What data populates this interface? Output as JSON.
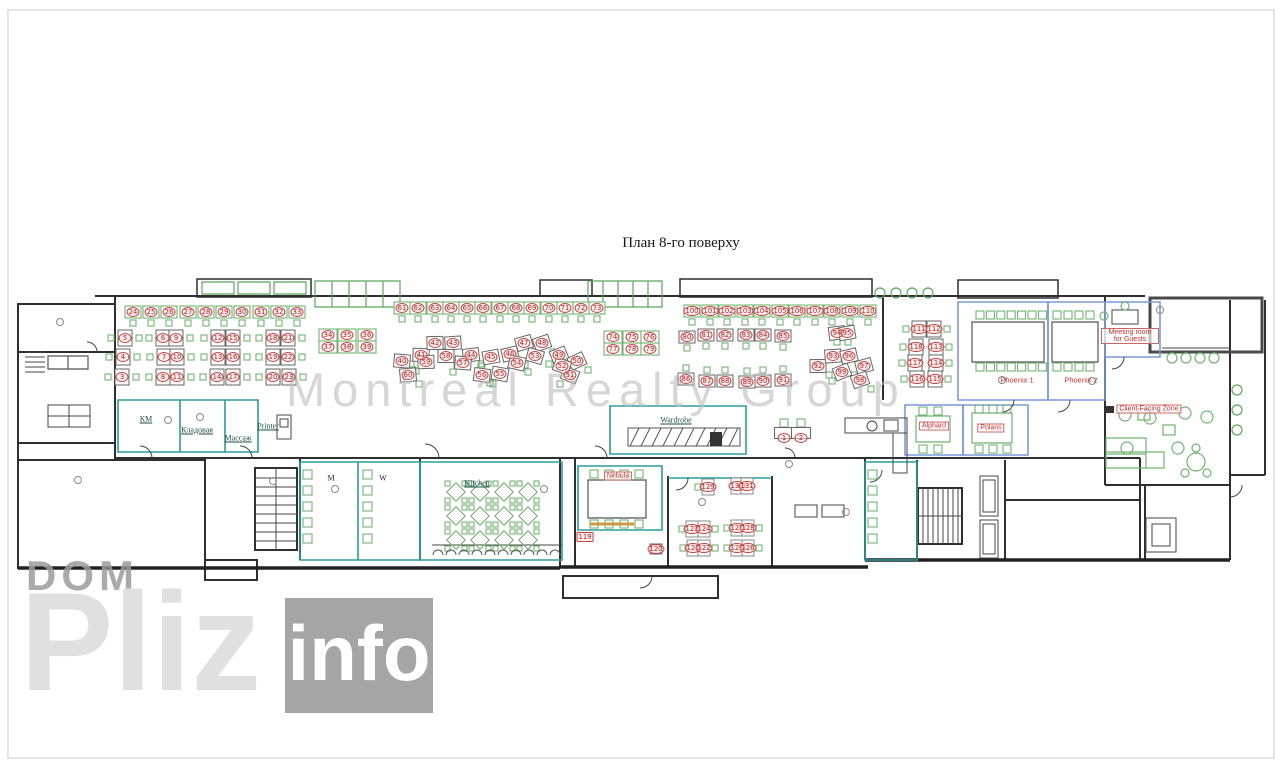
{
  "page": {
    "title": "План 8-го поверху"
  },
  "watermarks": {
    "center": "Montreal Realty Group",
    "brand_top": "DOM",
    "brand_large": "Pliz",
    "brand_suffix": "info"
  },
  "colors": {
    "wall": "#2f2f2f",
    "service_room": "#2a9d9c",
    "meeting_room": "#7b99d8",
    "furniture_green": "#72b372",
    "desk_number_red": "#b02020",
    "credenza_orange": "#d9943e",
    "watermark_gray": "#bdbdbd"
  },
  "room_labels": [
    {
      "text": "КМ",
      "x": 146,
      "y": 419,
      "style": "dark"
    },
    {
      "text": "Кладовая",
      "x": 197,
      "y": 430,
      "style": "dark"
    },
    {
      "text": "Массаж",
      "x": 238,
      "y": 438,
      "style": "dark"
    },
    {
      "text": "Printer",
      "x": 268,
      "y": 426,
      "style": "dark"
    },
    {
      "text": "Wardrobe",
      "x": 676,
      "y": 420,
      "style": "dark"
    },
    {
      "text": "Kitchen",
      "x": 477,
      "y": 483,
      "style": "dark"
    },
    {
      "text": "M",
      "x": 331,
      "y": 478,
      "style": "darkplain"
    },
    {
      "text": "W",
      "x": 383,
      "y": 478,
      "style": "darkplain"
    },
    {
      "text": "Nebula",
      "x": 618,
      "y": 476,
      "style": "redbox"
    },
    {
      "text": "Alphard",
      "x": 934,
      "y": 426,
      "style": "redbox"
    },
    {
      "text": "Polaris",
      "x": 991,
      "y": 428,
      "style": "redbox"
    },
    {
      "text": "Phoenix 1",
      "x": 1017,
      "y": 380,
      "style": "red"
    },
    {
      "text": "Phoenix 2",
      "x": 1081,
      "y": 380,
      "style": "red"
    },
    {
      "text": "Meeting room for Guests",
      "x": 1130,
      "y": 336,
      "style": "redbox",
      "wrap": true,
      "w": 52
    },
    {
      "text": "Client-Facing Zone",
      "x": 1149,
      "y": 409,
      "style": "redbox"
    }
  ],
  "desk_numbers": [
    [
      1,
      784,
      438
    ],
    [
      2,
      801,
      438
    ],
    [
      3,
      122,
      377
    ],
    [
      4,
      123,
      357
    ],
    [
      5,
      125,
      338
    ],
    [
      6,
      163,
      338
    ],
    [
      7,
      164,
      357
    ],
    [
      8,
      163,
      377
    ],
    [
      9,
      176,
      338
    ],
    [
      10,
      177,
      357
    ],
    [
      11,
      177,
      377
    ],
    [
      12,
      218,
      338
    ],
    [
      13,
      218,
      357
    ],
    [
      14,
      217,
      377
    ],
    [
      15,
      233,
      338
    ],
    [
      16,
      233,
      357
    ],
    [
      17,
      233,
      377
    ],
    [
      18,
      273,
      338
    ],
    [
      19,
      273,
      357
    ],
    [
      20,
      273,
      377
    ],
    [
      21,
      288,
      338
    ],
    [
      22,
      288,
      357
    ],
    [
      23,
      289,
      377
    ],
    [
      24,
      133,
      312
    ],
    [
      25,
      151,
      312
    ],
    [
      26,
      169,
      312
    ],
    [
      27,
      188,
      312
    ],
    [
      28,
      206,
      312
    ],
    [
      29,
      224,
      312
    ],
    [
      30,
      242,
      312
    ],
    [
      31,
      261,
      312
    ],
    [
      32,
      279,
      312
    ],
    [
      33,
      297,
      312
    ],
    [
      34,
      328,
      335
    ],
    [
      35,
      347,
      335
    ],
    [
      36,
      367,
      335
    ],
    [
      37,
      328,
      347
    ],
    [
      38,
      347,
      347
    ],
    [
      39,
      367,
      347
    ],
    [
      40,
      402,
      361
    ],
    [
      41,
      421,
      355
    ],
    [
      42,
      435,
      343
    ],
    [
      43,
      453,
      343
    ],
    [
      44,
      471,
      355
    ],
    [
      45,
      491,
      357
    ],
    [
      46,
      510,
      354
    ],
    [
      47,
      524,
      343
    ],
    [
      48,
      542,
      343
    ],
    [
      49,
      559,
      355
    ],
    [
      50,
      577,
      361
    ],
    [
      51,
      570,
      375
    ],
    [
      52,
      562,
      366
    ],
    [
      53,
      535,
      356
    ],
    [
      54,
      517,
      363
    ],
    [
      55,
      500,
      374
    ],
    [
      56,
      482,
      375
    ],
    [
      57,
      463,
      363
    ],
    [
      58,
      446,
      356
    ],
    [
      59,
      426,
      362
    ],
    [
      60,
      408,
      375
    ],
    [
      61,
      402,
      308
    ],
    [
      62,
      418,
      308
    ],
    [
      63,
      435,
      308
    ],
    [
      64,
      451,
      308
    ],
    [
      65,
      467,
      308
    ],
    [
      66,
      483,
      308
    ],
    [
      67,
      500,
      308
    ],
    [
      68,
      516,
      308
    ],
    [
      69,
      532,
      308
    ],
    [
      70,
      549,
      308
    ],
    [
      71,
      565,
      308
    ],
    [
      72,
      581,
      308
    ],
    [
      73,
      597,
      308
    ],
    [
      74,
      613,
      337
    ],
    [
      75,
      632,
      337
    ],
    [
      76,
      650,
      337
    ],
    [
      77,
      613,
      349
    ],
    [
      78,
      632,
      349
    ],
    [
      79,
      650,
      349
    ],
    [
      80,
      687,
      337
    ],
    [
      81,
      706,
      335
    ],
    [
      82,
      725,
      335
    ],
    [
      83,
      746,
      335
    ],
    [
      84,
      763,
      335
    ],
    [
      85,
      783,
      336
    ],
    [
      86,
      686,
      379
    ],
    [
      87,
      707,
      381
    ],
    [
      88,
      725,
      381
    ],
    [
      89,
      747,
      382
    ],
    [
      90,
      763,
      381
    ],
    [
      91,
      783,
      380
    ],
    [
      92,
      818,
      366
    ],
    [
      93,
      833,
      356
    ],
    [
      94,
      837,
      333
    ],
    [
      95,
      847,
      333
    ],
    [
      96,
      849,
      356
    ],
    [
      97,
      864,
      366
    ],
    [
      98,
      860,
      380
    ],
    [
      99,
      842,
      372
    ],
    [
      100,
      692,
      311
    ],
    [
      101,
      710,
      311
    ],
    [
      102,
      727,
      311
    ],
    [
      103,
      745,
      311
    ],
    [
      104,
      762,
      311
    ],
    [
      105,
      780,
      311
    ],
    [
      106,
      797,
      311
    ],
    [
      107,
      815,
      311
    ],
    [
      108,
      832,
      311
    ],
    [
      109,
      850,
      311
    ],
    [
      110,
      868,
      311
    ],
    [
      111,
      919,
      329
    ],
    [
      112,
      934,
      329
    ],
    [
      113,
      936,
      347
    ],
    [
      114,
      936,
      363
    ],
    [
      115,
      935,
      379
    ],
    [
      116,
      917,
      379
    ],
    [
      117,
      915,
      363
    ],
    [
      118,
      916,
      347
    ],
    [
      119,
      585,
      537
    ],
    [
      120,
      656,
      549
    ],
    [
      121,
      693,
      548
    ],
    [
      122,
      704,
      548
    ],
    [
      123,
      692,
      529
    ],
    [
      124,
      704,
      529
    ],
    [
      125,
      737,
      548
    ],
    [
      126,
      748,
      548
    ],
    [
      127,
      737,
      528
    ],
    [
      128,
      748,
      528
    ],
    [
      129,
      708,
      487
    ],
    [
      130,
      737,
      486
    ],
    [
      131,
      747,
      486
    ]
  ]
}
